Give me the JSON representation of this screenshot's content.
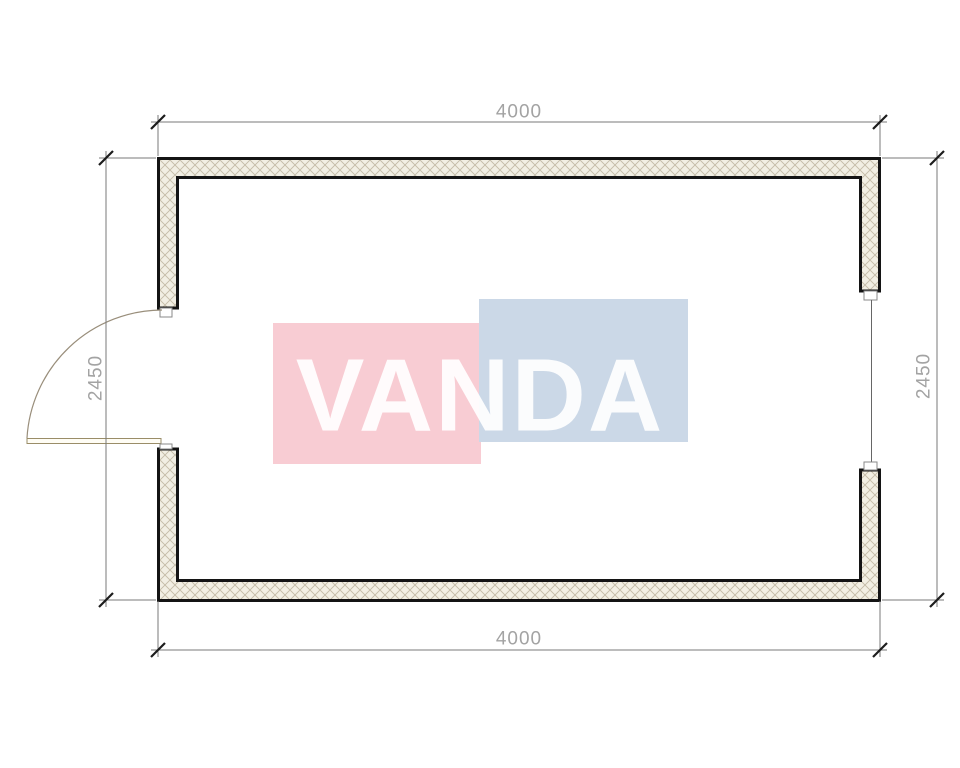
{
  "plan": {
    "type": "floor-plan",
    "dimensions": {
      "top": "4000",
      "bottom": "4000",
      "left": "2450",
      "right": "2450"
    },
    "watermark": {
      "text": "VANDA",
      "pink": "#f8ccd3",
      "blue": "#cbd8e7"
    },
    "colors": {
      "wall_outline": "#141414",
      "wall_fill": "#f2efe3",
      "hatch_line": "#c4bba6",
      "dimension_line": "#7a7a7a",
      "tick": "#1c1c1c",
      "dimension_text": "#a3a3a3",
      "door_arc": "#998e7b",
      "window_line": "#666666"
    },
    "features": {
      "door": "left-wall-door-swing",
      "window": "right-wall-window"
    }
  }
}
